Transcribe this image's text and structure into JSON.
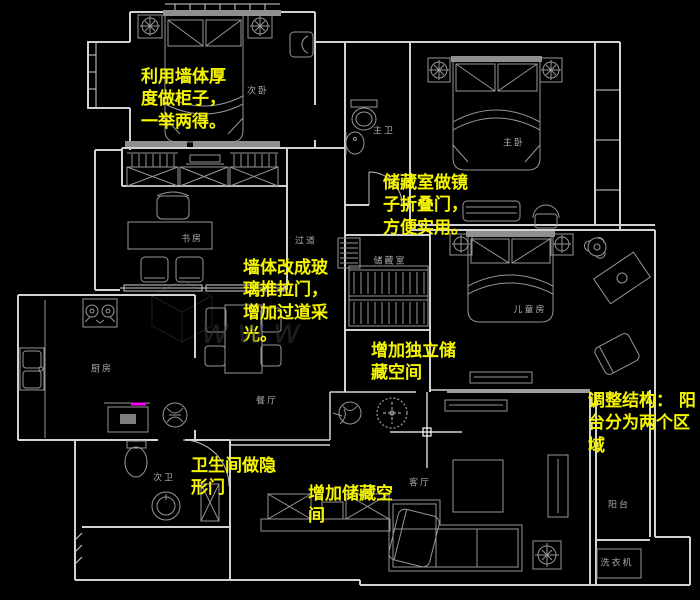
{
  "colors": {
    "background": "#000000",
    "wall_line": "#d2d2d2",
    "furniture_line": "#969696",
    "annotation_yellow": "#f6f600",
    "room_label_gray": "#a9a9a9",
    "accent_magenta": "#ff00ff",
    "cursor_white": "#ffffff"
  },
  "annotations": [
    {
      "id": "note-wall-thickness-cabinet",
      "text": "利用墙体厚度做柜子，一举两得。",
      "x": 141,
      "y": 66,
      "w": 90
    },
    {
      "id": "note-storage-mirror-folding-door",
      "text": "储藏室做镜子折叠门，方便实用。",
      "x": 383,
      "y": 172,
      "w": 90
    },
    {
      "id": "note-glass-sliding-door",
      "text": "墙体改成玻璃推拉门，增加过道采光。",
      "x": 243,
      "y": 257,
      "w": 90
    },
    {
      "id": "note-independent-storage",
      "text": "增加独立储藏空间",
      "x": 371,
      "y": 340,
      "w": 92
    },
    {
      "id": "note-balcony-two-zones",
      "text": "调整结构： 阳台分为两个区域",
      "x": 588,
      "y": 390,
      "w": 110
    },
    {
      "id": "note-bathroom-hidden-door",
      "text": "卫生间做隐形门",
      "x": 191,
      "y": 455,
      "w": 92
    },
    {
      "id": "note-add-storage-space",
      "text": "增加储藏空间",
      "x": 308,
      "y": 483,
      "w": 92
    }
  ],
  "rooms": [
    {
      "id": "room-secondary-bedroom",
      "name": "次卧",
      "x": 258,
      "y": 90
    },
    {
      "id": "room-master-bathroom",
      "name": "主卫",
      "x": 384,
      "y": 130
    },
    {
      "id": "room-master-bedroom",
      "name": "主卧",
      "x": 514,
      "y": 142
    },
    {
      "id": "room-study",
      "name": "书房",
      "x": 192,
      "y": 238
    },
    {
      "id": "room-corridor",
      "name": "过道",
      "x": 306,
      "y": 240
    },
    {
      "id": "room-storage",
      "name": "储藏室",
      "x": 390,
      "y": 260
    },
    {
      "id": "room-kids-room",
      "name": "儿童房",
      "x": 530,
      "y": 309
    },
    {
      "id": "room-kitchen",
      "name": "厨房",
      "x": 102,
      "y": 368
    },
    {
      "id": "room-dining",
      "name": "餐厅",
      "x": 267,
      "y": 400
    },
    {
      "id": "room-living",
      "name": "客厅",
      "x": 420,
      "y": 482
    },
    {
      "id": "room-second-bathroom",
      "name": "次卫",
      "x": 164,
      "y": 477
    },
    {
      "id": "room-balcony",
      "name": "阳台",
      "x": 619,
      "y": 504
    },
    {
      "id": "label-washing-machine",
      "name": "洗衣机",
      "x": 617,
      "y": 562
    }
  ],
  "watermark": {
    "text": "www"
  }
}
